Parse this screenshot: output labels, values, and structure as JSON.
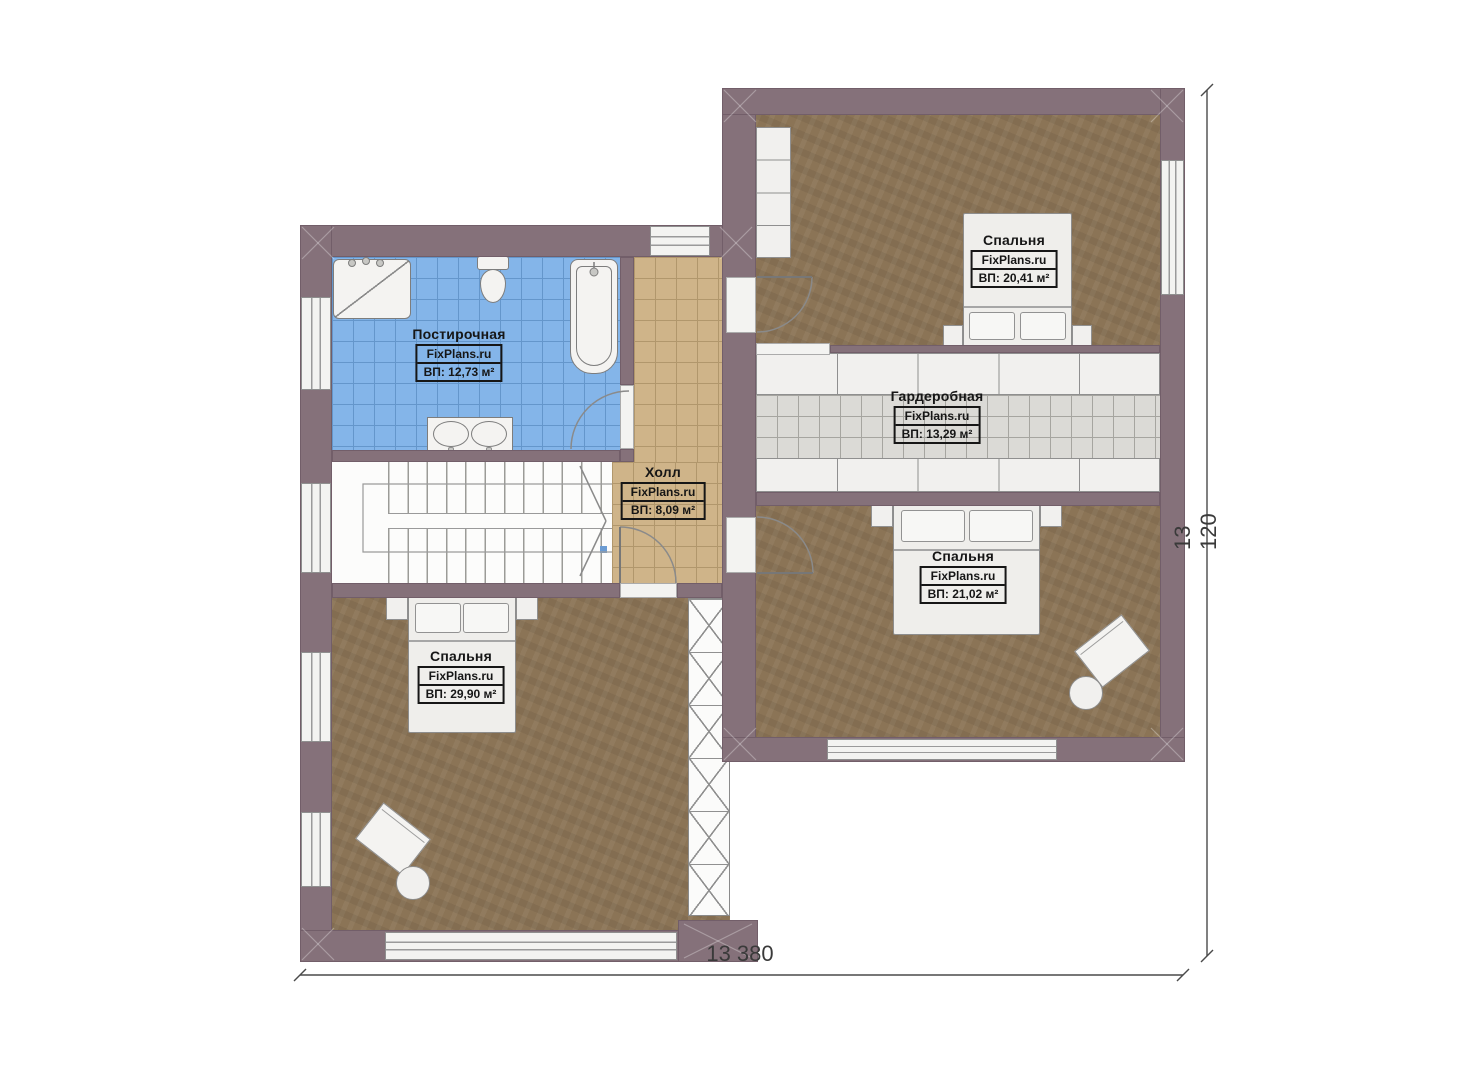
{
  "watermark": "FixPlans.ru",
  "rooms": {
    "laundry": {
      "name": "Постирочная",
      "site": "FixPlans.ru",
      "area": "ВП: 12,73 м²"
    },
    "hall": {
      "name": "Холл",
      "site": "FixPlans.ru",
      "area": "ВП: 8,09 м²"
    },
    "bedroom_top_right": {
      "name": "Спальня",
      "site": "FixPlans.ru",
      "area": "ВП: 20,41 м²"
    },
    "wardrobe": {
      "name": "Гардеробная",
      "site": "FixPlans.ru",
      "area": "ВП: 13,29 м²"
    },
    "bedroom_bottom_right": {
      "name": "Спальня",
      "site": "FixPlans.ru",
      "area": "ВП: 21,02 м²"
    },
    "bedroom_bottom_left": {
      "name": "Спальня",
      "site": "FixPlans.ru",
      "area": "ВП: 29,90 м²"
    }
  },
  "dimensions": {
    "width_label": "13 380",
    "height_label": "13 120"
  },
  "colors": {
    "wall": "#85717A",
    "floor_wood": "#8B7456",
    "tile_blue": "#84B5E9",
    "tile_hall": "#CFB489",
    "tile_gray": "#DBDAD6"
  }
}
